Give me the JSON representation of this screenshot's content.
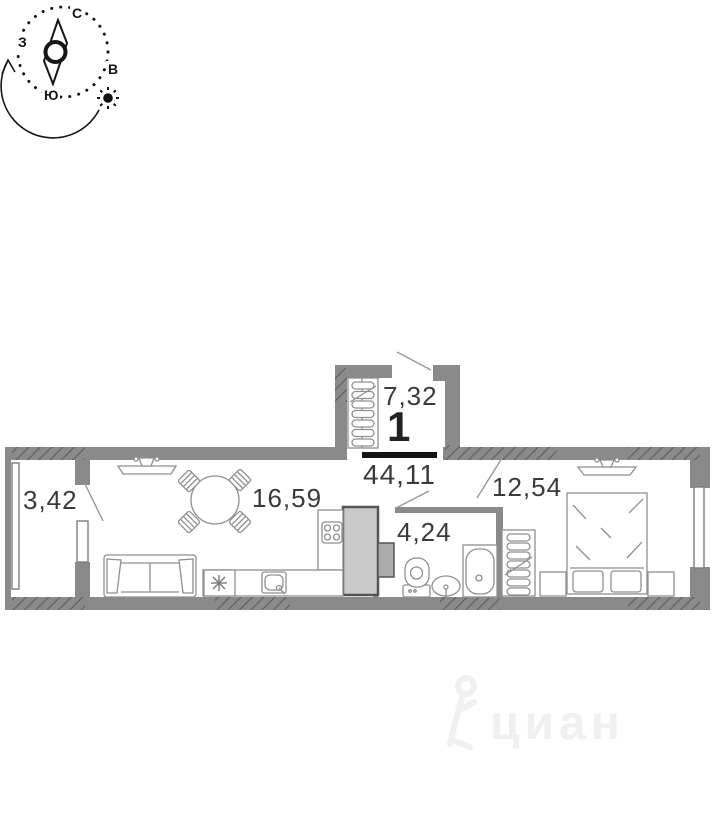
{
  "compass": {
    "north": "С",
    "east": "В",
    "south": "Ю",
    "west": "З"
  },
  "apartment": {
    "number": "1",
    "total_area": "44,11"
  },
  "rooms": {
    "hall": {
      "area": "7,32"
    },
    "balcony": {
      "area": "3,42"
    },
    "living_kitchen": {
      "area": "16,59"
    },
    "bathroom": {
      "area": "4,24"
    },
    "bedroom": {
      "area": "12,54"
    }
  },
  "watermark": {
    "brand": "циан"
  },
  "colors": {
    "wall": "#8a8a8a",
    "wall_hatch": "#5f5f5f",
    "shaft_fill": "#c9c9c9",
    "furniture_line": "#8f8f8f",
    "label_text": "#3a3a3a",
    "area_underline": "#141414",
    "watermark": "#f0f0f0"
  }
}
